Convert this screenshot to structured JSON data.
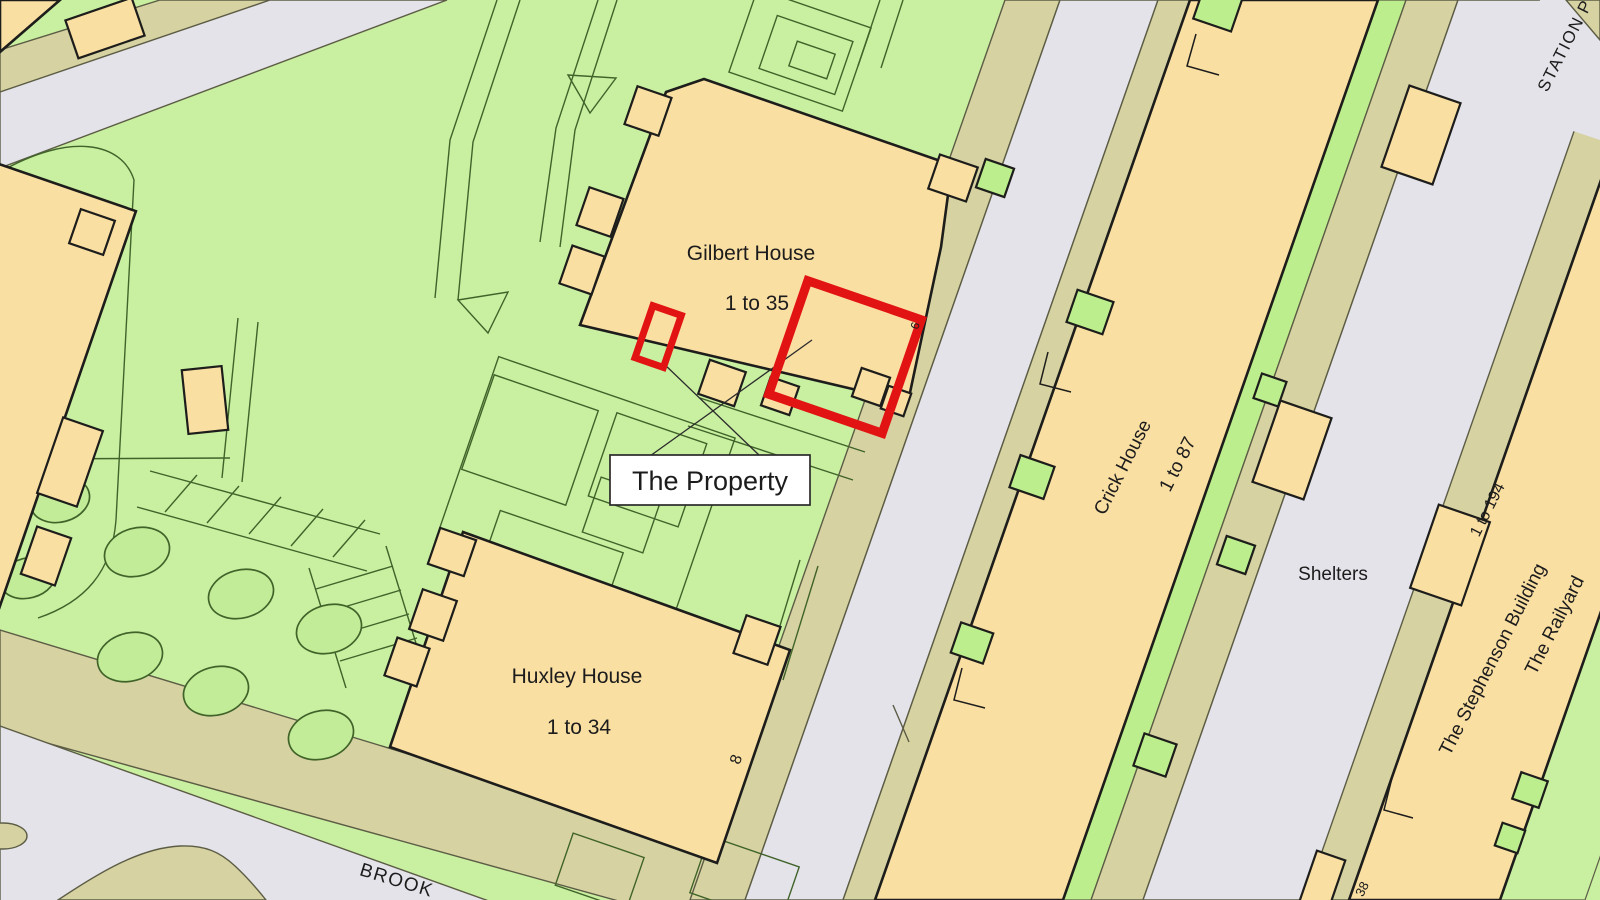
{
  "map": {
    "colors": {
      "green": "#c9efa1",
      "green_accent": "#bdee8d",
      "tree": "#c3ec98",
      "building": "#fadfa3",
      "pavement": "#d6d2a2",
      "road": "#e3e3e9",
      "outline": "#1d1d1b",
      "edge": "#5c5c45",
      "path": "#40632a",
      "red": "#e21313",
      "label_bg": "#ffffff"
    },
    "buildings": {
      "gilbert": {
        "name": "Gilbert House",
        "range": "1 to 35"
      },
      "huxley": {
        "name": "Huxley House",
        "range": "1 to 34"
      },
      "crick": {
        "name": "Crick House",
        "range": "1 to 87"
      },
      "stephenson": {
        "name": "The Stephenson Building",
        "range": "1 to 194"
      },
      "railyard": {
        "name": "The Railyard"
      }
    },
    "labels": {
      "property": "The Property",
      "shelters": "Shelters",
      "station_road": "STATION P",
      "brook_road": "BROOK",
      "number_8": "8",
      "number_6": "6",
      "number_38": "38"
    }
  }
}
